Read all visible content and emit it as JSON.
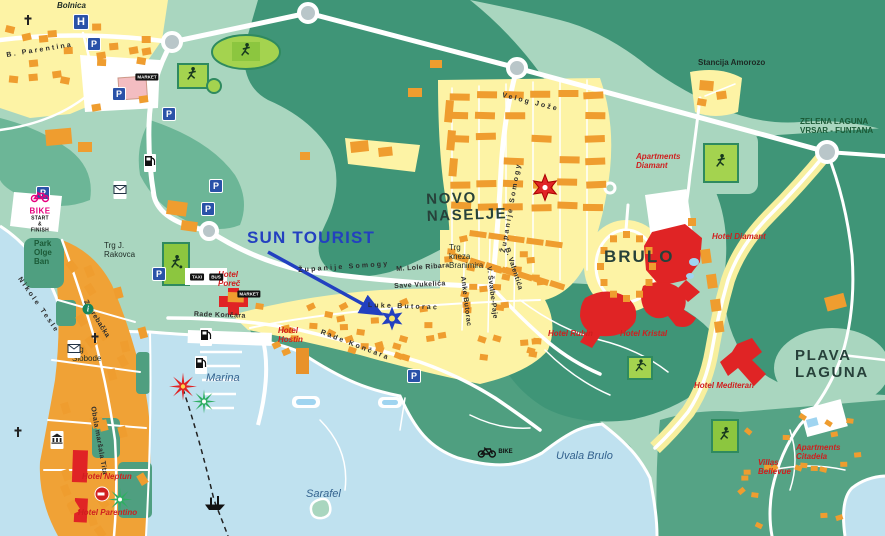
{
  "map": {
    "name": "Porec tourist map with Sun Tourist marker",
    "width": 885,
    "height": 536,
    "colors": {
      "sea": "#bfe1ef",
      "land": "#a9d6bf",
      "forest_dark": "#3f9577",
      "forest_mid": "#55a385",
      "residential_yellow": "#fdf3a5",
      "building_orange": "#ef9d2f",
      "oldtown_orange": "#f0a236",
      "hotel_red": "#e02425",
      "road_white": "#ffffff",
      "brand_blue": "#2340c0",
      "hotel_label_red": "#cf1e1e",
      "sport_green": "#9ace52",
      "icon_blue": "#2a52a8",
      "bike_magenta": "#e6007e"
    }
  },
  "labels": [
    {
      "t": "SUN TOURIST",
      "x": 247,
      "y": 228,
      "r": 0,
      "c": "brand"
    },
    {
      "t": "NOVO\nNASELJE",
      "x": 426,
      "y": 192,
      "r": -2,
      "c": "area-lg"
    },
    {
      "t": "BRULO",
      "x": 604,
      "y": 247,
      "r": 0,
      "c": "area-lg xl"
    },
    {
      "t": "PLAVA\nLAGUNA",
      "x": 795,
      "y": 348,
      "r": 0,
      "c": "area-lg"
    },
    {
      "t": "Marina",
      "x": 206,
      "y": 372,
      "r": 0,
      "c": "sea"
    },
    {
      "t": "Sarafel",
      "x": 306,
      "y": 488,
      "r": 0,
      "c": "sea"
    },
    {
      "t": "Uvala Brulo",
      "x": 556,
      "y": 450,
      "r": 0,
      "c": "sea"
    },
    {
      "t": "Stancija Amorozo",
      "x": 698,
      "y": 59,
      "r": 0,
      "c": "area-sm bold"
    },
    {
      "t": "ZELENA LAGUNA\nVRSAR - FUNTANA",
      "x": 800,
      "y": 118,
      "r": 0,
      "c": "area-sm green"
    },
    {
      "t": "Bolnica",
      "x": 57,
      "y": 2,
      "r": 0,
      "c": "area-sm italic"
    },
    {
      "t": "Park\nOlge\nBan",
      "x": 34,
      "y": 240,
      "r": 0,
      "c": "area-sm green"
    },
    {
      "t": "Trg J.\nRakovca",
      "x": 104,
      "y": 242,
      "r": 0,
      "c": "area-sm"
    },
    {
      "t": "Trg\nSlobode",
      "x": 72,
      "y": 346,
      "r": 0,
      "c": "area-sm"
    },
    {
      "t": "Trg\nkneza\nBranimira",
      "x": 449,
      "y": 244,
      "r": 0,
      "c": "area-sm"
    },
    {
      "t": "Županije Somogy",
      "x": 298,
      "y": 267,
      "r": -4,
      "c": "street sp"
    },
    {
      "t": "Županije Somogy",
      "x": 500,
      "y": 252,
      "r": -80,
      "c": "street sp"
    },
    {
      "t": "M. Lole Ribara",
      "x": 396,
      "y": 266,
      "r": -4,
      "c": "street"
    },
    {
      "t": "Save Vukelića",
      "x": 394,
      "y": 283,
      "r": -3,
      "c": "street"
    },
    {
      "t": "Luke Butorac",
      "x": 368,
      "y": 302,
      "r": 2,
      "c": "street sp"
    },
    {
      "t": "Rade Končara",
      "x": 194,
      "y": 311,
      "r": 2,
      "c": "street"
    },
    {
      "t": "Rade Končara",
      "x": 322,
      "y": 329,
      "r": 21,
      "c": "street sp"
    },
    {
      "t": "Anke Butorac",
      "x": 466,
      "y": 276,
      "r": 83,
      "c": "street"
    },
    {
      "t": "V. Švalbe-Paje",
      "x": 492,
      "y": 266,
      "r": 83,
      "c": "street"
    },
    {
      "t": "B. Valentića",
      "x": 510,
      "y": 247,
      "r": 72,
      "c": "street"
    },
    {
      "t": "Velog Jože",
      "x": 503,
      "y": 92,
      "r": 14,
      "c": "street sp"
    },
    {
      "t": "Nikole Tesle",
      "x": 22,
      "y": 276,
      "r": 55,
      "c": "street sp"
    },
    {
      "t": "Obala maršala Tita",
      "x": 96,
      "y": 406,
      "r": 80,
      "c": "street"
    },
    {
      "t": "Zagrebačka",
      "x": 88,
      "y": 299,
      "r": 58,
      "c": "street"
    },
    {
      "t": "B. Parentina",
      "x": 6,
      "y": 52,
      "r": -9,
      "c": "street sp"
    },
    {
      "t": "Hotel\nPoreč",
      "x": 218,
      "y": 271,
      "r": 0,
      "c": "hotel"
    },
    {
      "t": "Hotel\nHostin",
      "x": 278,
      "y": 327,
      "r": 0,
      "c": "hotel"
    },
    {
      "t": "Hotel Neptun",
      "x": 82,
      "y": 473,
      "r": 0,
      "c": "hotel"
    },
    {
      "t": "Hotel Parentino",
      "x": 78,
      "y": 509,
      "r": 0,
      "c": "hotel"
    },
    {
      "t": "Hotel Diamant",
      "x": 712,
      "y": 233,
      "r": 0,
      "c": "hotel"
    },
    {
      "t": "Apartments\nDiamant",
      "x": 636,
      "y": 153,
      "r": 0,
      "c": "hotel"
    },
    {
      "t": "Hotel Rubin",
      "x": 548,
      "y": 330,
      "r": 0,
      "c": "hotel"
    },
    {
      "t": "Hotel Kristal",
      "x": 620,
      "y": 330,
      "r": 0,
      "c": "hotel"
    },
    {
      "t": "Hotel Mediteran",
      "x": 694,
      "y": 382,
      "r": 0,
      "c": "hotel"
    },
    {
      "t": "Apartments\nCitadela",
      "x": 796,
      "y": 444,
      "r": 0,
      "c": "hotel"
    },
    {
      "t": "Villas\nBellevue",
      "x": 758,
      "y": 459,
      "r": 0,
      "c": "hotel"
    }
  ],
  "icons": [
    {
      "type": "hospital",
      "x": 81,
      "y": 22,
      "label": "H"
    },
    {
      "type": "parking",
      "x": 94,
      "y": 44,
      "label": "P"
    },
    {
      "type": "parking",
      "x": 119,
      "y": 94,
      "label": "P"
    },
    {
      "type": "parking",
      "x": 169,
      "y": 114,
      "label": "P"
    },
    {
      "type": "parking",
      "x": 43,
      "y": 193,
      "label": "P"
    },
    {
      "type": "parking",
      "x": 216,
      "y": 186,
      "label": "P"
    },
    {
      "type": "parking",
      "x": 208,
      "y": 209,
      "label": "P"
    },
    {
      "type": "parking",
      "x": 159,
      "y": 274,
      "label": "P"
    },
    {
      "type": "parking",
      "x": 414,
      "y": 376,
      "label": "P"
    },
    {
      "type": "market",
      "x": 147,
      "y": 77,
      "label": "MARKET"
    },
    {
      "type": "market",
      "x": 249,
      "y": 294,
      "label": "MARKET"
    },
    {
      "type": "taxi",
      "x": 197,
      "y": 277,
      "label": "TAXI"
    },
    {
      "type": "bus",
      "x": 216,
      "y": 277,
      "label": "BUS"
    },
    {
      "type": "fuel",
      "x": 150,
      "y": 163
    },
    {
      "type": "fuel",
      "x": 206,
      "y": 337
    },
    {
      "type": "fuel",
      "x": 201,
      "y": 365
    },
    {
      "type": "post",
      "x": 120,
      "y": 190
    },
    {
      "type": "post",
      "x": 74,
      "y": 349
    },
    {
      "type": "church",
      "x": 28,
      "y": 22
    },
    {
      "type": "church",
      "x": 95,
      "y": 340
    },
    {
      "type": "church",
      "x": 18,
      "y": 434
    },
    {
      "type": "museum",
      "x": 57,
      "y": 440
    },
    {
      "type": "info",
      "x": 88,
      "y": 309
    },
    {
      "type": "noentry",
      "x": 102,
      "y": 494
    },
    {
      "type": "ship",
      "x": 215,
      "y": 505
    },
    {
      "type": "runner",
      "x": 246,
      "y": 52
    },
    {
      "type": "runner",
      "x": 192,
      "y": 76
    },
    {
      "type": "runner",
      "x": 721,
      "y": 163
    },
    {
      "type": "runner",
      "x": 725,
      "y": 436
    },
    {
      "type": "soccer",
      "x": 176,
      "y": 264
    },
    {
      "type": "tennis",
      "x": 640,
      "y": 368
    },
    {
      "type": "bike-start",
      "x": 40,
      "y": 212,
      "lines": [
        "BIKE",
        "START & FINISH"
      ]
    },
    {
      "type": "bike-trail",
      "x": 495,
      "y": 452,
      "label": "BIKE"
    },
    {
      "type": "red-star",
      "x": 545,
      "y": 190
    },
    {
      "type": "blue-star",
      "x": 392,
      "y": 321
    },
    {
      "type": "burst-red",
      "x": 183,
      "y": 389
    },
    {
      "type": "burst-green",
      "x": 204,
      "y": 404
    },
    {
      "type": "burst-green",
      "x": 120,
      "y": 502
    }
  ]
}
